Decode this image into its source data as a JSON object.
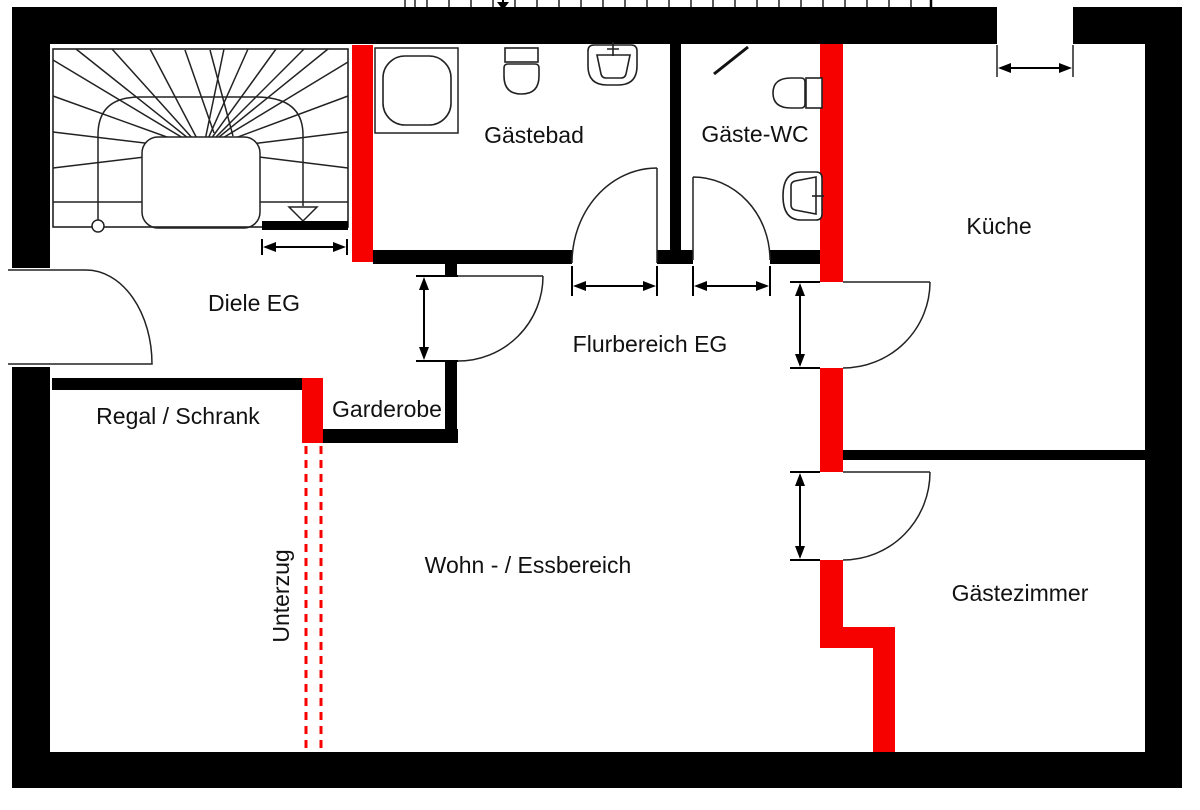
{
  "rooms": [
    {
      "id": "gaestebad",
      "label": "Gästebad"
    },
    {
      "id": "gaeste-wc",
      "label": "Gäste-WC"
    },
    {
      "id": "kueche",
      "label": "Küche"
    },
    {
      "id": "diele-eg",
      "label": "Diele EG"
    },
    {
      "id": "flurbereich-eg",
      "label": "Flurbereich EG"
    },
    {
      "id": "regal-schrank",
      "label": "Regal / Schrank"
    },
    {
      "id": "garderobe",
      "label": "Garderobe"
    },
    {
      "id": "wohn-essbereich",
      "label": "Wohn - / Essbereich"
    },
    {
      "id": "gaestezimmer",
      "label": "Gästezimmer"
    }
  ],
  "beam_label": "Unterzug",
  "colors": {
    "wall": "#000000",
    "highlight": "#f70000",
    "line": "#222222",
    "text": "#111111"
  },
  "fixtures": {
    "gaestebad": [
      "shower",
      "toilet",
      "washbasin"
    ],
    "gaeste_wc": [
      "toilet",
      "washbasin"
    ]
  }
}
